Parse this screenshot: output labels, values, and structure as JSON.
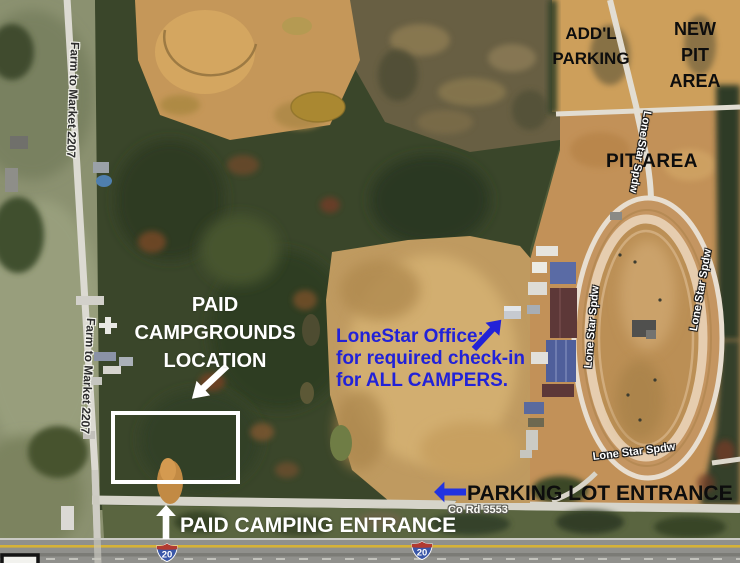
{
  "labels": {
    "addl_parking": "ADD'L\nPARKING",
    "new_pit_area": "NEW\nPIT\nAREA",
    "pit_area": "PIT AREA",
    "paid_campgrounds": "PAID\nCAMPGROUNDS\nLOCATION",
    "office_note": "LoneStar Office:\nfor required check-in\nfor ALL CAMPERS.",
    "parking_lot_entrance": "PARKING LOT ENTRANCE",
    "paid_camping_entrance": "PAID CAMPING ENTRANCE"
  },
  "roads": {
    "farm_to_market": "Farm to Market 2207",
    "co_rd": "Co Rd 3553",
    "speedway_road": "Lone Star Spdw",
    "interstate_shield": "20"
  },
  "colors": {
    "annotation_blue": "#2222d8",
    "annotation_white": "#ffffff",
    "annotation_black": "#0d0d0d",
    "dirt_tan": "#c49a5e",
    "forest_green": "#3a462a"
  }
}
